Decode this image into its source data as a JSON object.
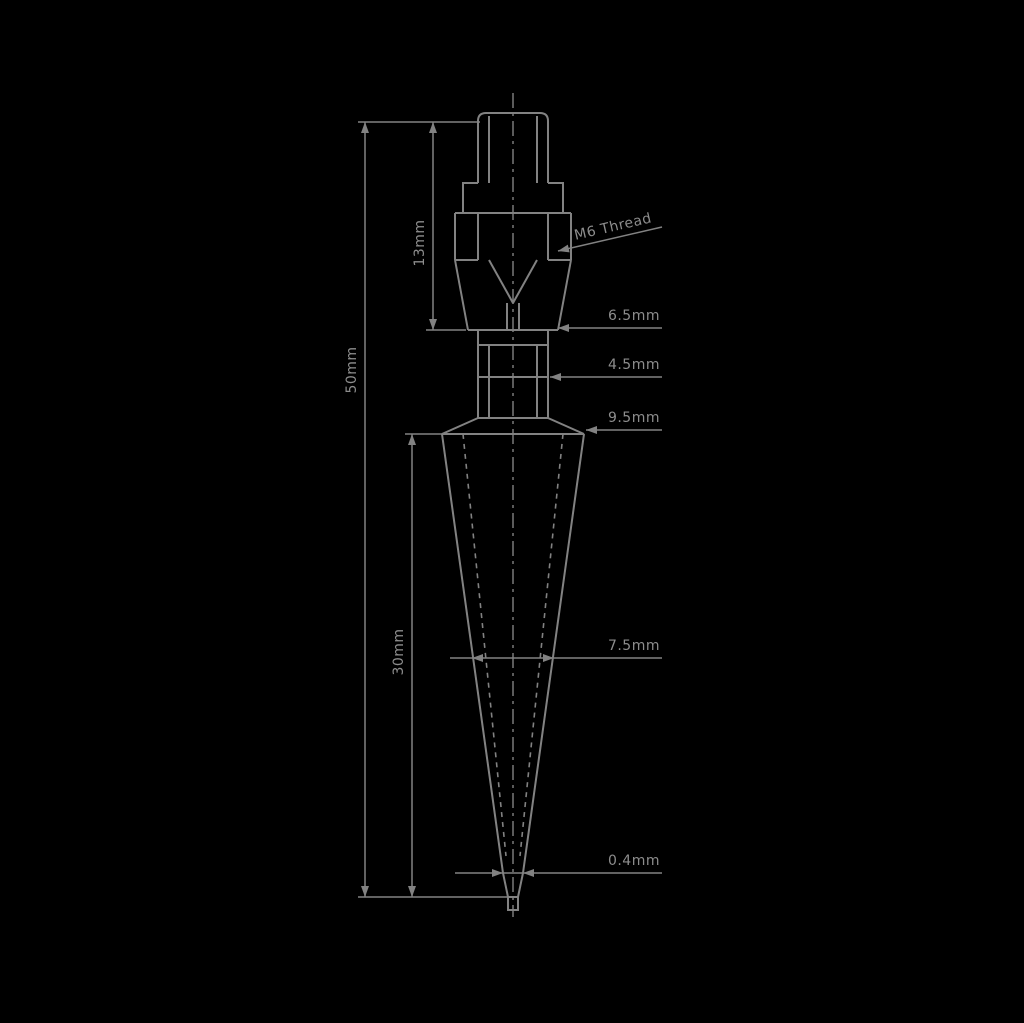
{
  "colors": {
    "background": "#000000",
    "line": "#828282",
    "text": "#8d8d8d"
  },
  "annotations": {
    "thread_callout": "M6 Thread",
    "overall_length": "50mm",
    "upper_section_length": "13mm",
    "taper_length": "30mm",
    "seat_diameter": "6.5mm",
    "flats_width": "4.5mm",
    "taper_top_diameter": "9.5mm",
    "taper_mid_diameter": "7.5mm",
    "tip_orifice": "0.4mm"
  }
}
